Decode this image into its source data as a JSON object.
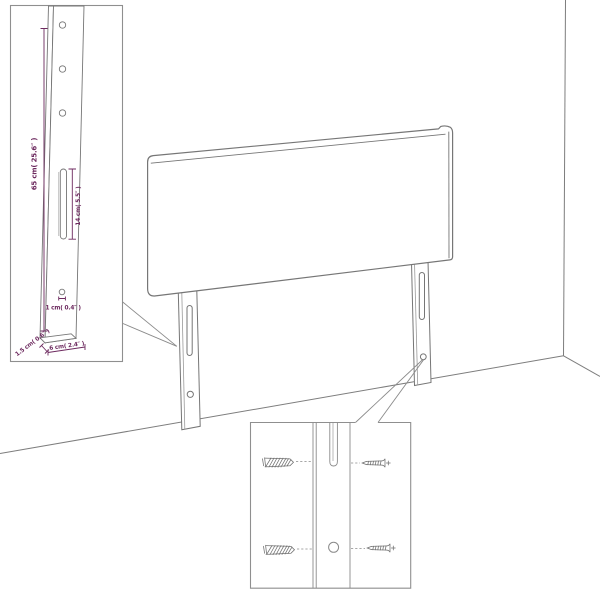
{
  "palette": {
    "background": "#ffffff",
    "line_work": "#767676",
    "inset_border": "#8f8f8f",
    "dimension_accent": "#6d2a5f"
  },
  "left_inset": {
    "labels": {
      "leg_height": "65 cm( 25.6″ )",
      "slot_length": "14 cm( 5.5″ )",
      "hole_diameter": "1 cm( 0.4″ )",
      "leg_thickness": "1.5 cm( 0.6″ )",
      "leg_width": "6 cm( 2.4″ )"
    }
  }
}
